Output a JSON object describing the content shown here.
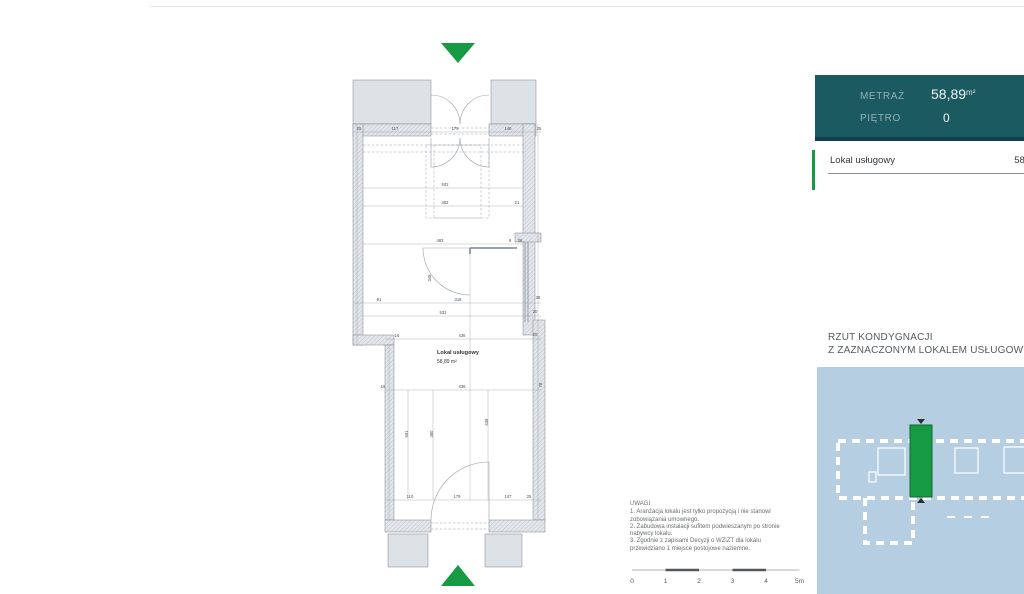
{
  "colors": {
    "accent_green": "#169a44",
    "panel_teal": "#1b5a61",
    "panel_teal_dark": "#0e3f47",
    "map_bg": "#b5cee2",
    "wall_fill": "#e2e6ea",
    "wall_stroke": "#7c848e"
  },
  "info_panel": {
    "metraz_label": "METRAŻ",
    "metraz_value": "58,89",
    "metraz_unit": "m²",
    "pietro_label": "PIĘTRO",
    "pietro_value": "0"
  },
  "unit_row": {
    "label": "Lokal usługowy",
    "value": "58,89"
  },
  "section_title": {
    "line1": "RZUT KONDYGNACJI",
    "line2": "Z ZAZNACZONYM LOKALEM USŁUGOWYM"
  },
  "floor_plan": {
    "room_label": "Lokal usługowy",
    "room_area": "58,89 m²",
    "dim_labels": [
      {
        "x": 14,
        "y": 100,
        "t": "25"
      },
      {
        "x": 50,
        "y": 100,
        "t": "117"
      },
      {
        "x": 110,
        "y": 100,
        "t": "179"
      },
      {
        "x": 163,
        "y": 100,
        "t": "146"
      },
      {
        "x": 194,
        "y": 100,
        "t": "25"
      },
      {
        "x": 100,
        "y": 156,
        "t": "502"
      },
      {
        "x": 100,
        "y": 174,
        "t": "302"
      },
      {
        "x": 172,
        "y": 174,
        "t": "21"
      },
      {
        "x": 95,
        "y": 212,
        "t": "483"
      },
      {
        "x": 165,
        "y": 212,
        "t": "8"
      },
      {
        "x": 175,
        "y": 212,
        "t": "36"
      },
      {
        "x": 86,
        "y": 248,
        "t": "348",
        "rot": -90
      },
      {
        "x": 34,
        "y": 271,
        "t": "91"
      },
      {
        "x": 113,
        "y": 271,
        "t": "318"
      },
      {
        "x": 193,
        "y": 269,
        "t": "38"
      },
      {
        "x": 98,
        "y": 284,
        "t": "531"
      },
      {
        "x": 190,
        "y": 283,
        "t": "20"
      },
      {
        "x": 52,
        "y": 307,
        "t": "16"
      },
      {
        "x": 117,
        "y": 307,
        "t": "436"
      },
      {
        "x": 190,
        "y": 306,
        "t": "20"
      },
      {
        "x": 38,
        "y": 358,
        "t": "16"
      },
      {
        "x": 117,
        "y": 358,
        "t": "436"
      },
      {
        "x": 197,
        "y": 355,
        "t": "78",
        "rot": -90
      },
      {
        "x": 63,
        "y": 404,
        "t": "591",
        "rot": -90
      },
      {
        "x": 88,
        "y": 404,
        "t": "380",
        "rot": -90
      },
      {
        "x": 143,
        "y": 392,
        "t": "638",
        "rot": -90
      },
      {
        "x": 65,
        "y": 468,
        "t": "110"
      },
      {
        "x": 112,
        "y": 468,
        "t": "179"
      },
      {
        "x": 163,
        "y": 468,
        "t": "147"
      },
      {
        "x": 184,
        "y": 468,
        "t": "25"
      }
    ]
  },
  "notes": {
    "heading": "UWAGI",
    "lines": [
      "1. Aranżacja lokalu jest tylko propozycją i nie stanowi",
      "zobowiązania umownego.",
      "2. Zabudowa instalacji sufitem podwieszanym po stronie",
      "nabywcy lokalu.",
      "3. Zgodnie z zapisami Decyzji o WZiZT dla lokalu",
      "przewidziano 1 miejsce postojowe naziemne."
    ]
  },
  "scale_bar": {
    "labels": [
      "0",
      "1",
      "2",
      "3",
      "4",
      "5m"
    ]
  }
}
